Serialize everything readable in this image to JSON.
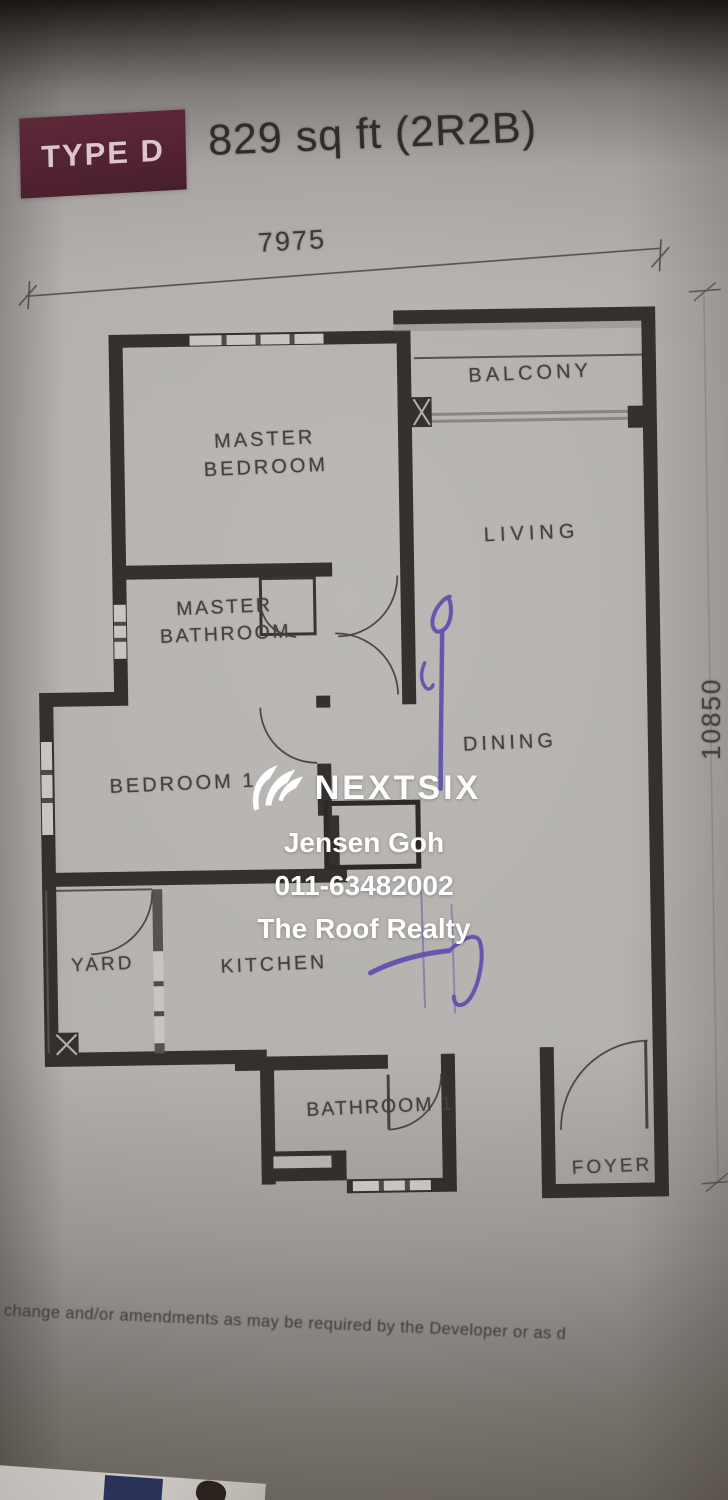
{
  "photo": {
    "header": {
      "type_badge": "TYPE D",
      "title": "829 sq ft (2R2B)"
    },
    "dimensions": {
      "width": "7975",
      "height": "10850"
    },
    "rooms": {
      "balcony": "BALCONY",
      "master_bedroom": "MASTER BEDROOM",
      "living": "LIVING",
      "master_bathroom": "MASTER BATHROOM",
      "dining": "DINING",
      "bedroom1": "BEDROOM 1",
      "yard": "YARD",
      "kitchen": "KITCHEN",
      "bathroom1": "BATHROOM 1",
      "foyer": "FOYER"
    },
    "watermark": {
      "brand": "NEXTSIX",
      "agent_name": "Jensen Goh",
      "agent_phone": "011-63482002",
      "agency": "The Roof Realty"
    },
    "disclaimer": "t to change and/or amendments as may be required by the Developer or as d",
    "colors": {
      "badge_bg": "#532334",
      "badge_text": "#dcc6ca",
      "wall": "#2b2724",
      "label_text": "#44403b",
      "pen_mark": "#5a48ad",
      "watermark_text": "#ffffff",
      "paper": "#b2afac"
    }
  }
}
